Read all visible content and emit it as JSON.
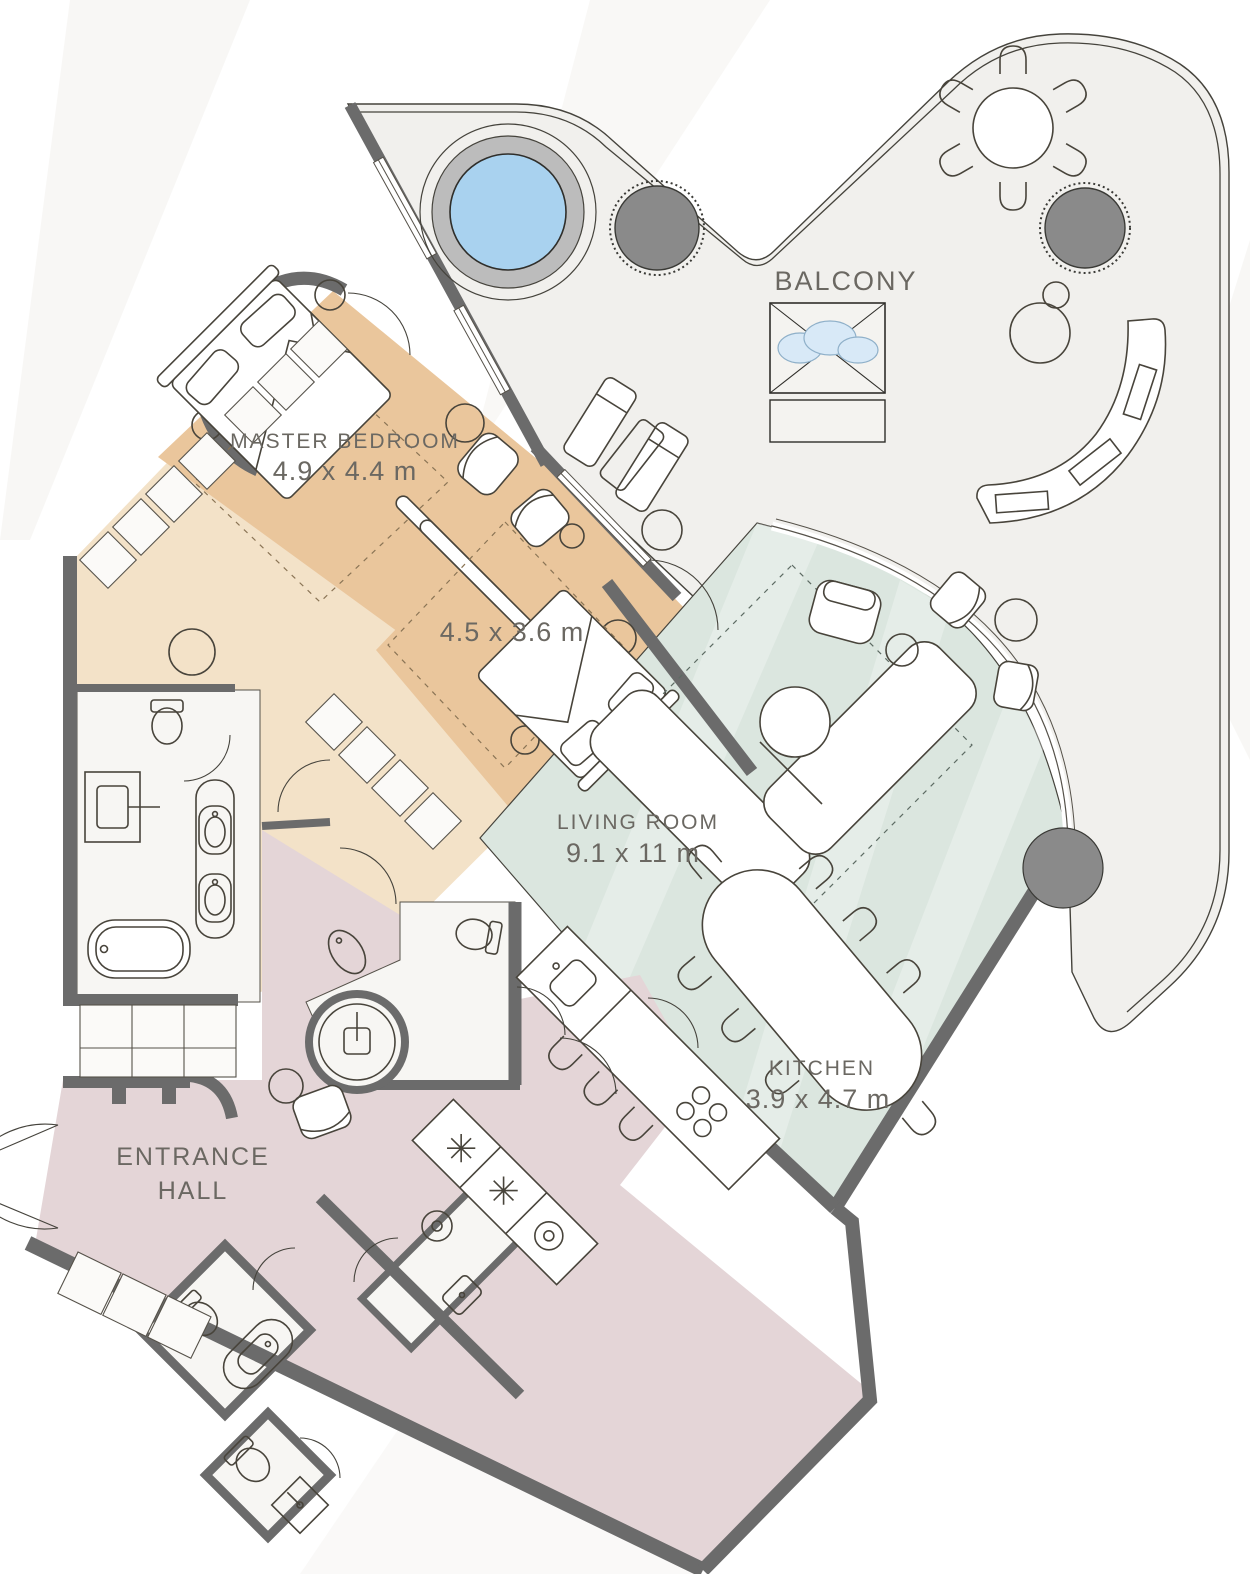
{
  "plan": {
    "balcony": {
      "label": "BALCONY"
    },
    "master_bedroom": {
      "label": "MASTER BEDROOM",
      "dimensions": "4.9 x 4.4 m"
    },
    "bedroom_2": {
      "dimensions": "4.5 x 3.6 m"
    },
    "living_room": {
      "label": "LIVING ROOM",
      "dimensions": "9.1 x 11 m"
    },
    "kitchen": {
      "label": "KITCHEN",
      "dimensions": "3.9 x 4.7 m"
    },
    "entrance_hall": {
      "line1": "ENTRANCE",
      "line2": "HALL"
    }
  },
  "colors": {
    "wall": "#6b6b6b",
    "balcony_floor": "#f1f0ed",
    "bedroom_floor": "#eac69c",
    "dressing_floor": "#f3e2c8",
    "living_floor": "#dbe6df",
    "hall_floor": "#e4d5d7",
    "bathroom_floor": "#f7f6f3",
    "hot_tub_water": "#a9d2ef",
    "hot_tub_ring": "#bcbcbc",
    "fire_pit": "#8a8a8a",
    "cloud": "#d8e9f7",
    "label_text": "#6b6862"
  }
}
